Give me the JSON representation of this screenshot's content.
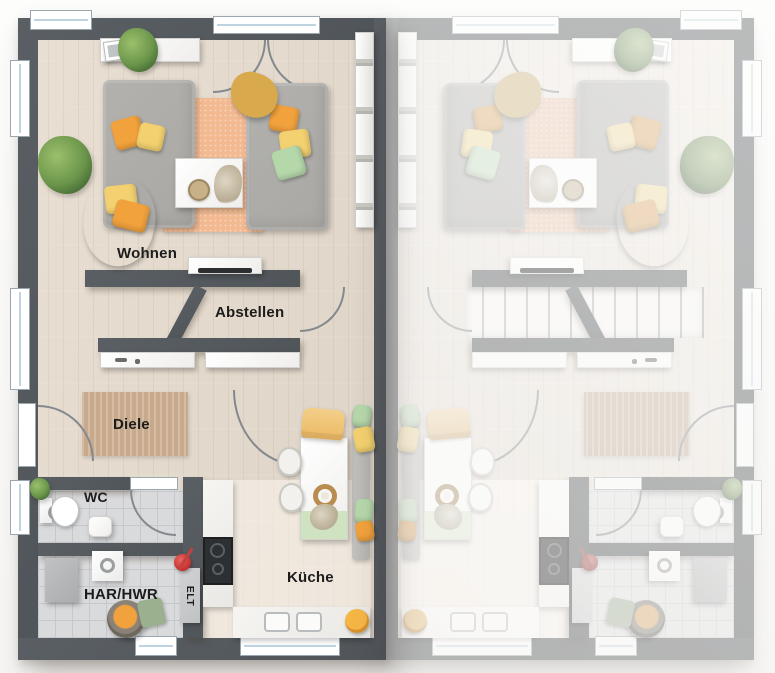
{
  "rooms": {
    "wohnen": "Wohnen",
    "abstellen": "Abstellen",
    "diele": "Diele",
    "wc": "WC",
    "har_hwr": "HAR/HWR",
    "elt": "ELT",
    "kueche": "Küche"
  },
  "colors": {
    "wall": "#5a5f64",
    "floor": "#ddd3c6",
    "floorLight": "#e9dfd3",
    "tile": "#d9dadc",
    "tileLine": "#c6c8cb",
    "rugPeach": "#f3ba92",
    "rugJute": "#c9a98b",
    "sofa": "#a9a8a4",
    "orange": "#f2a23d",
    "yellow": "#f3d170",
    "mustard": "#d9a94e",
    "green": "#b5d8ab",
    "greenPale": "#cfe3c0",
    "counter": "#f6f5f2",
    "cooktop": "#2d3033",
    "window": "#ffffff",
    "windowLine": "#bdd3e0",
    "arc": "#84898e",
    "label": "#1c1c1c"
  }
}
